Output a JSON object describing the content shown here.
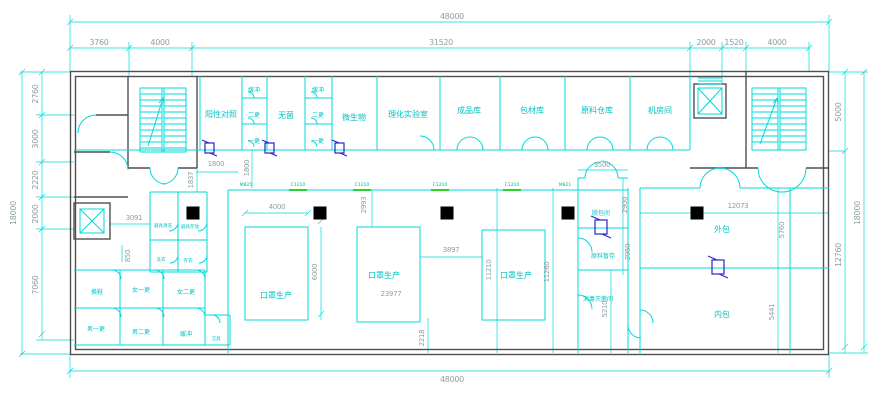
{
  "colors": {
    "line": "#00d9d9",
    "wall": "#4f4f4f",
    "dim_text": "#8d9fa4",
    "room_text": "#00c3c3",
    "window_highlight": "#27d427",
    "pass_box": "#2525cc",
    "column_fill": "#000000"
  },
  "rooms": {
    "positive_control": "阳性对照",
    "buffer_a": "缓冲",
    "second_change_a": "二更",
    "first_change_a": "一更",
    "sterile": "无菌",
    "buffer_b": "缓冲",
    "second_change_b": "二更",
    "first_change_b": "一更",
    "microbiology": "微生物",
    "physchem_lab": "理化实验室",
    "finished_goods": "成品库",
    "packaging_materials": "包材库",
    "raw_materials_warehouse": "原料仓库",
    "machine_room": "机房间",
    "mask_production_1": "口罩生产",
    "mask_production_2": "口罩生产",
    "mask_production_3": "口罩生产",
    "unpacking_room": "脱包间",
    "raw_material_staging": "原料暂存",
    "sterilization_room": "消毒灭菌间",
    "outer_packaging": "外包",
    "inner_packaging": "内包",
    "shoe_change": "换鞋",
    "women_first_change": "女一更",
    "women_second_change": "女二更",
    "men_first_change": "男一更",
    "men_second_change": "男二更",
    "buffer_c": "缓冲",
    "cleaning_tools": "洁具",
    "utensil_washing": "器具清洗",
    "utensil_storage": "器具存放",
    "laundry": "洗衣",
    "garment_storage": "存衣"
  },
  "tags": {
    "door_left": "M825",
    "window": "C1210",
    "door_right": "M821"
  },
  "dims": {
    "overall_width_top": "48000",
    "overall_width_bottom": "48000",
    "top_1": "3760",
    "top_2": "4000",
    "top_3": "31520",
    "top_4": "2000",
    "top_5": "1520",
    "top_6": "4000",
    "left_overall": "18000",
    "left_1": "2760",
    "left_2": "3000",
    "left_3": "2220",
    "left_4": "2000",
    "left_5": "7060",
    "right_overall": "18000",
    "right_1": "5000",
    "right_2": "12760",
    "int_1800_h": "1800",
    "int_1800_v": "1800",
    "int_1837": "1837",
    "int_3091": "3091",
    "int_850": "850",
    "int_4000": "4000",
    "int_6000": "6000",
    "int_2993": "2993",
    "int_3897": "3897",
    "int_23977": "23977",
    "int_11210": "11210",
    "int_11260": "11260",
    "int_2218": "2218",
    "int_3500": "3500",
    "int_2900": "2900",
    "int_2950": "2950",
    "int_5210": "5210",
    "int_12073": "12073",
    "int_5760": "5760",
    "int_5441": "5441"
  }
}
